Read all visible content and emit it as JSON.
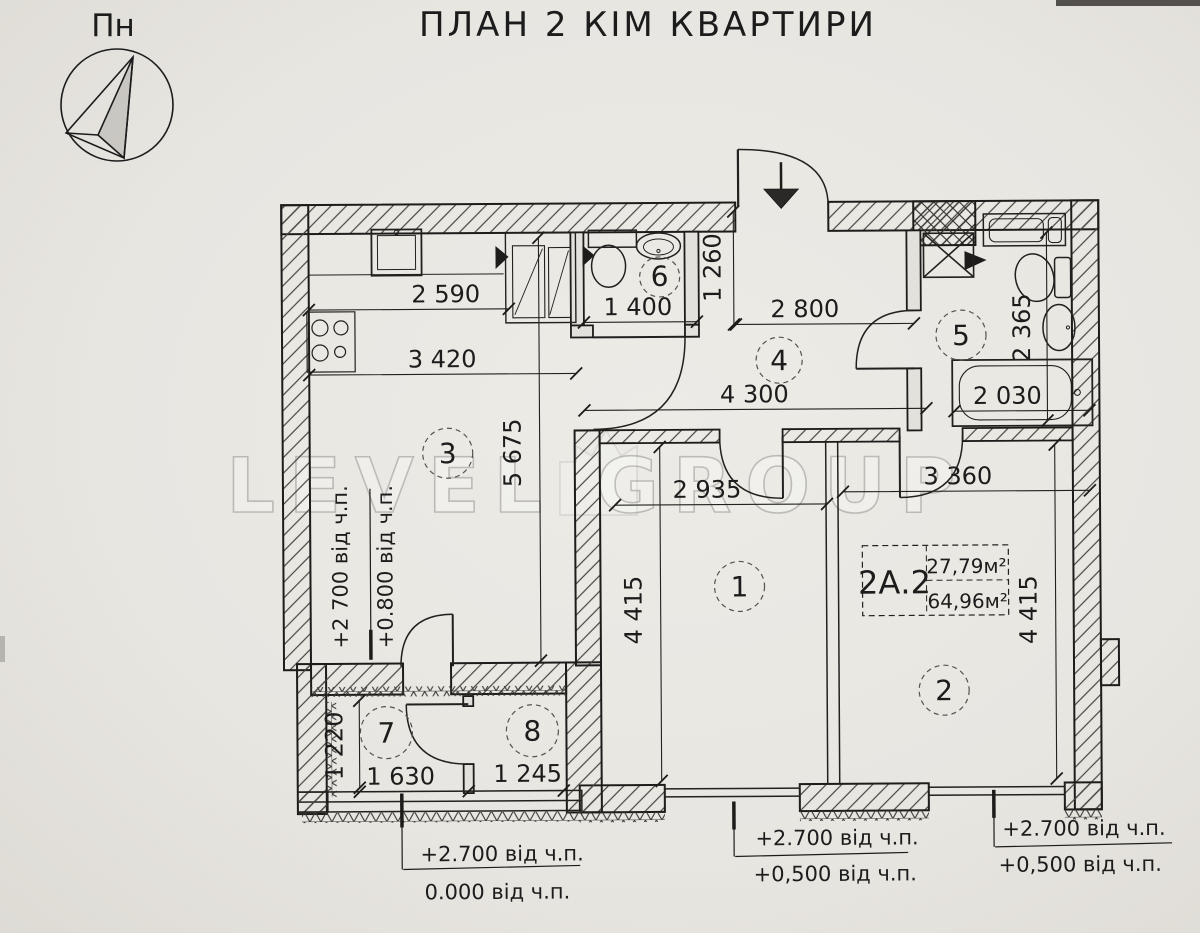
{
  "title": "ПЛАН 2 КІМ КВАРТИРИ",
  "compass": {
    "label": "Пн"
  },
  "watermark": {
    "text": "LEVEL GROUP"
  },
  "apartment_tag": {
    "code": "2А.2",
    "upper_area": "27,79м²",
    "lower_area": "64,96м²"
  },
  "rooms": [
    "1",
    "2",
    "3",
    "4",
    "5",
    "6",
    "7",
    "8"
  ],
  "dims": {
    "d2590": "2 590",
    "d3420": "3 420",
    "d1400": "1 400",
    "d1260": "1 260",
    "d2800": "2 800",
    "d4300": "4 300",
    "d2030": "2 030",
    "d2365": "2 365",
    "d5675": "5 675",
    "d2935": "2 935",
    "d3360": "3 360",
    "d4415_left": "4 415",
    "d4415_right": "4 415",
    "d1220": "1 220",
    "d1630": "1 630",
    "d1245": "1 245"
  },
  "elevations": {
    "left_outer": "+2 700 від ч.п.",
    "left_inner": "+0.800 від ч.п.",
    "bottom_left_top": "+2.700 від ч.п.",
    "bottom_left_bottom": "0.000 від ч.п.",
    "bottom_mid_top": "+2.700 від ч.п.",
    "bottom_mid_bottom": "+0,500 від ч.п.",
    "bottom_right_top": "+2.700 від ч.п.",
    "bottom_right_bottom": "+0,500 від ч.п."
  }
}
